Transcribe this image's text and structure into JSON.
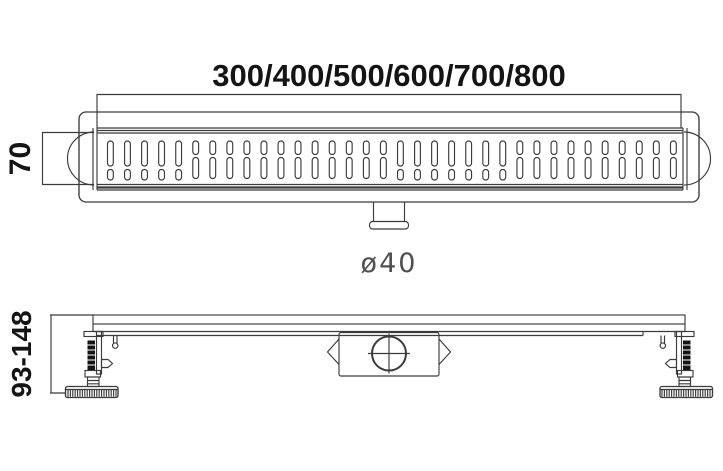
{
  "drawing": {
    "labels": {
      "length": "300/400/500/600/700/800",
      "channel_width": "70",
      "outlet_diameter": "ø40",
      "install_height_range": "93-148"
    },
    "colors": {
      "background": "#ffffff",
      "line": "#3b3b3b",
      "text": "#141414",
      "cad_text": "#4f4f4f"
    },
    "grate": {
      "slot_columns": 34
    }
  }
}
